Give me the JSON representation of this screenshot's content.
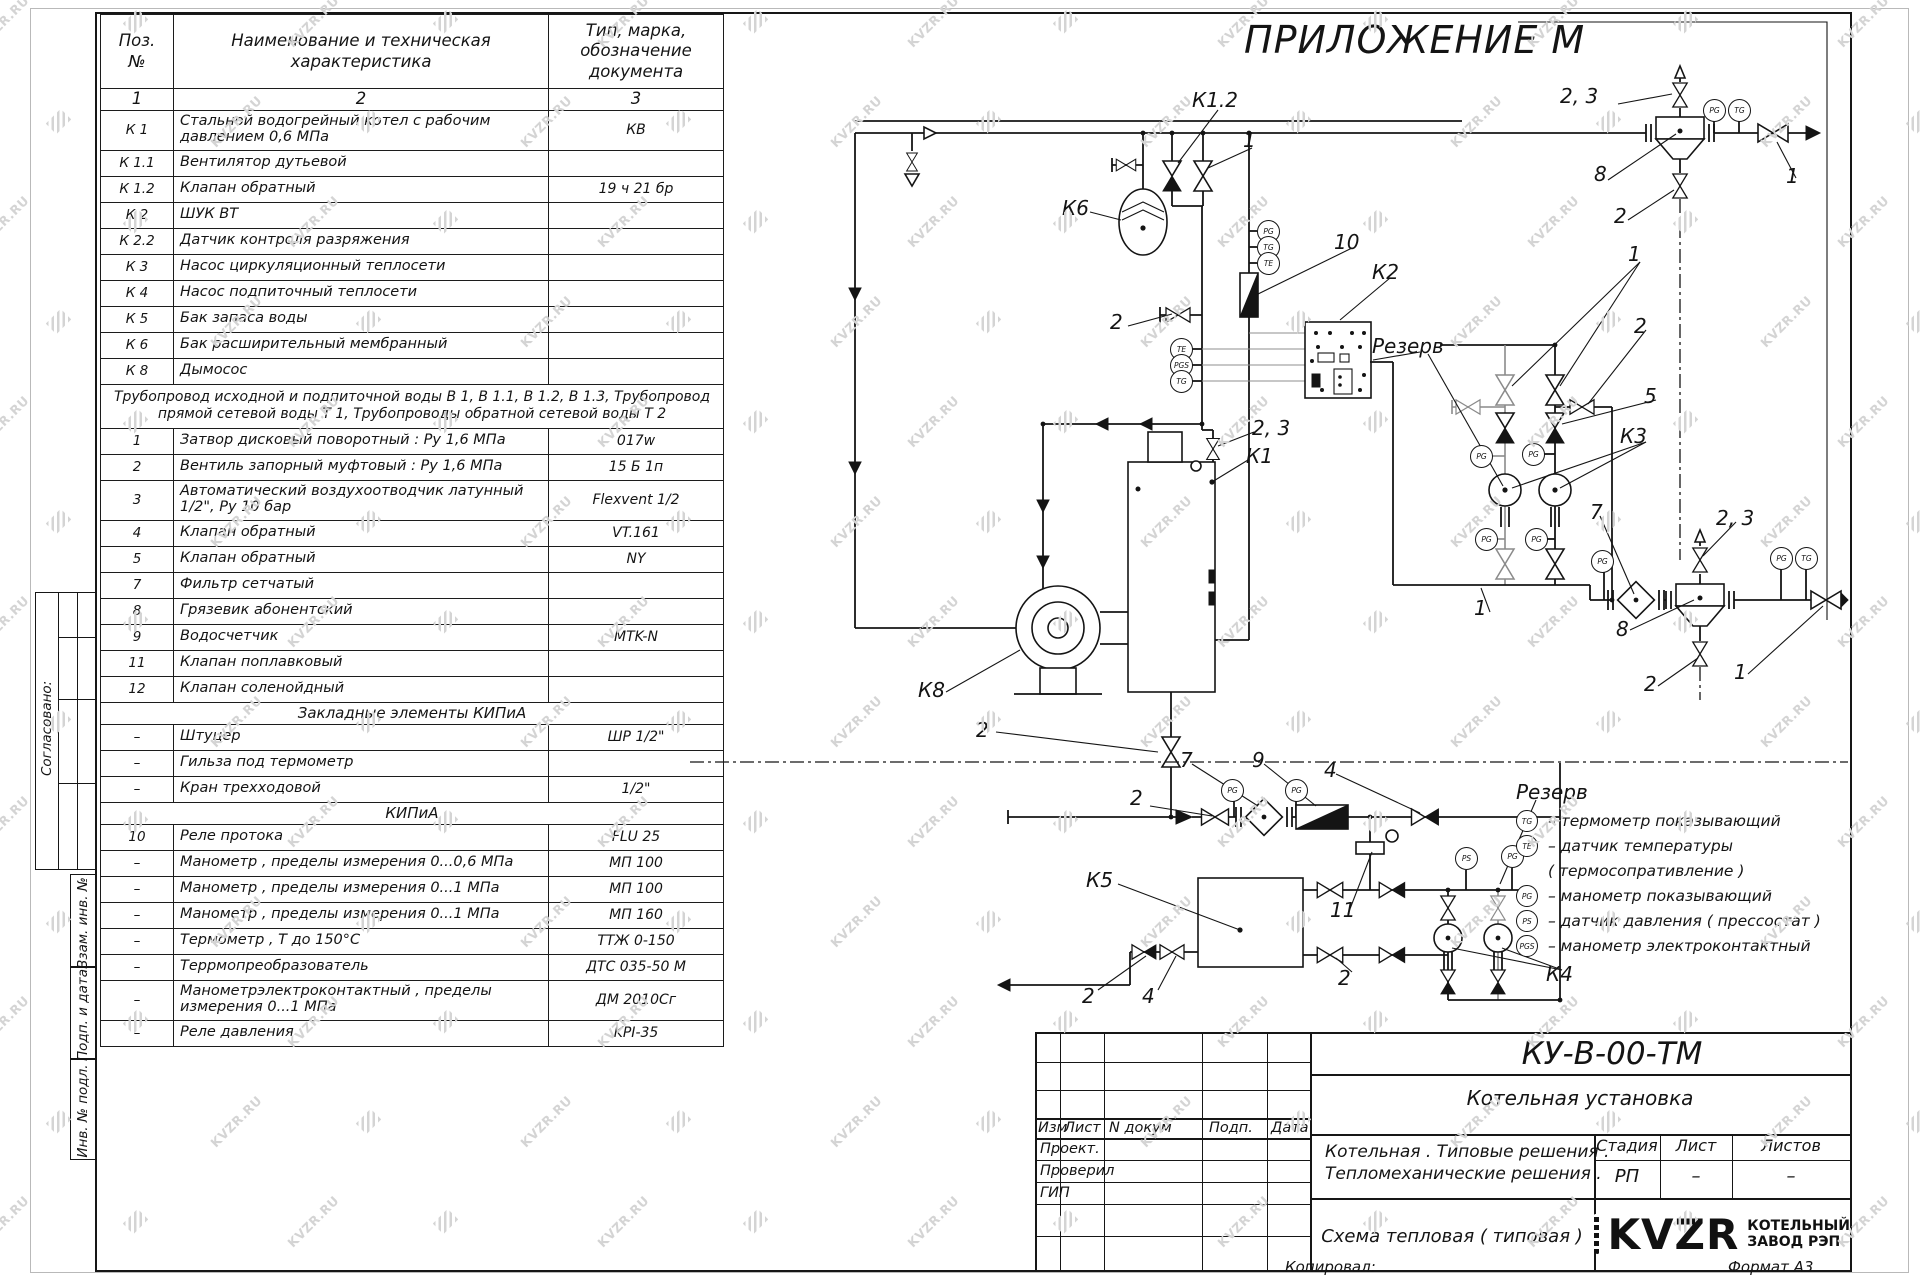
{
  "appendix_title": "ПРИЛОЖЕНИЕ  М",
  "watermark": {
    "text": "KVZR.RU"
  },
  "colors": {
    "ink": "#141414",
    "watermark": "#d4d4d4",
    "paper": "#ffffff"
  },
  "margin": {
    "approved": "Согласовано:",
    "vzam": "Взам. инв. №",
    "podp": "Подп. и дата",
    "inv": "Инв. № подл."
  },
  "spec_table": {
    "col1": "Поз.\n№",
    "col2": "Наименование и техническая\nхарактеристика",
    "col3": "Тип, марка,\nобозначение\nдокумента",
    "index": [
      "1",
      "2",
      "3"
    ],
    "rows": [
      {
        "p": "К 1",
        "n": "Стальной водогрейный котел с рабочим давлением 0,6  МПа",
        "t": "КВ",
        "tall": 1
      },
      {
        "p": "К 1.1",
        "n": "Вентилятор дутьевой",
        "t": ""
      },
      {
        "p": "К 1.2",
        "n": "Клапан обратный",
        "t": "19 ч 21 бр"
      },
      {
        "p": "К 2",
        "n": "ШУК ВТ",
        "t": ""
      },
      {
        "p": "К 2.2",
        "n": "Датчик контроля разряжения",
        "t": ""
      },
      {
        "p": "К 3",
        "n": "Насос циркуляционный теплосети",
        "t": ""
      },
      {
        "p": "К 4",
        "n": "Насос подпиточный теплосети",
        "t": ""
      },
      {
        "p": "К 5",
        "n": "Бак запаса воды",
        "t": ""
      },
      {
        "p": "К 6",
        "n": "Бак расширительный мембранный",
        "t": ""
      },
      {
        "p": "К 8",
        "n": "Дымосос",
        "t": ""
      },
      {
        "note": "Трубопровод исходной и подпиточной воды В 1,   В 1.1,   В 1.2, В 1.3,  Трубопровод прямой сетевой воды Т 1,  Трубопроводы обратной сетевой воды Т 2"
      },
      {
        "p": "1",
        "n": "Затвор дисковый поворотный :  Ру 1,6  МПа",
        "t": "017w"
      },
      {
        "p": "2",
        "n": "Вентиль запорный муфтовый :  Ру 1,6  МПа",
        "t": "15 Б 1п"
      },
      {
        "p": "3",
        "n": "Автоматический воздухоотводчик  латунный 1/2\",  Ру 10 бар",
        "t": "Flexvent 1/2",
        "tall": 1
      },
      {
        "p": "4",
        "n": "Клапан обратный",
        "t": "VT.161"
      },
      {
        "p": "5",
        "n": "Клапан обратный",
        "t": "NY"
      },
      {
        "p": "7",
        "n": "Фильтр сетчатый",
        "t": ""
      },
      {
        "p": "8",
        "n": "Грязевик абонентский",
        "t": ""
      },
      {
        "p": "9",
        "n": "Водосчетчик",
        "t": "MTK-N"
      },
      {
        "p": "11",
        "n": "Клапан поплавковый",
        "t": ""
      },
      {
        "p": "12",
        "n": "Клапан соленойдный",
        "t": ""
      },
      {
        "sec": "Закладные элементы КИПиА"
      },
      {
        "p": "–",
        "n": "Штуцер",
        "t": "ШР  1/2\""
      },
      {
        "p": "–",
        "n": "Гильза под термометр",
        "t": ""
      },
      {
        "p": "–",
        "n": "Кран трехходовой",
        "t": "1/2\""
      },
      {
        "sec": "КИПиА"
      },
      {
        "p": "10",
        "n": "Реле протока",
        "t": "FLU 25"
      },
      {
        "p": "–",
        "n": "Манометр ,  пределы измерения  0...0,6 МПа",
        "t": "МП 100"
      },
      {
        "p": "–",
        "n": "Манометр ,  пределы измерения  0...1 МПа",
        "t": "МП 100"
      },
      {
        "p": "–",
        "n": "Манометр ,  пределы измерения  0...1 МПа",
        "t": "МП 160"
      },
      {
        "p": "–",
        "n": "Термометр ,  Т  до  150°С",
        "t": "ТТЖ  0-150"
      },
      {
        "p": "–",
        "n": "Террмопреобразователь",
        "t": "ДТС 035-50 М"
      },
      {
        "p": "–",
        "n": "Манометрэлектроконтактный ,  пределы измерения 0...1 МПа",
        "t": "ДМ 2010Сг",
        "tall": 1
      },
      {
        "p": "–",
        "n": "Реле давления",
        "t": "KPI-35"
      }
    ]
  },
  "diagram": {
    "labels": [
      {
        "t": "К1.2",
        "x": 1192,
        "y": 88
      },
      {
        "t": "1",
        "x": 1243,
        "y": 128
      },
      {
        "t": "2, 3",
        "x": 1560,
        "y": 84
      },
      {
        "t": "8",
        "x": 1594,
        "y": 162
      },
      {
        "t": "2",
        "x": 1614,
        "y": 204
      },
      {
        "t": "1",
        "x": 1786,
        "y": 164
      },
      {
        "t": "К6",
        "x": 1062,
        "y": 196
      },
      {
        "t": "10",
        "x": 1334,
        "y": 230
      },
      {
        "t": "К2",
        "x": 1372,
        "y": 260
      },
      {
        "t": "2",
        "x": 1110,
        "y": 310
      },
      {
        "t": "Резерв",
        "x": 1372,
        "y": 334
      },
      {
        "t": "1",
        "x": 1628,
        "y": 242
      },
      {
        "t": "2",
        "x": 1634,
        "y": 314
      },
      {
        "t": "5",
        "x": 1644,
        "y": 384
      },
      {
        "t": "К3",
        "x": 1620,
        "y": 424
      },
      {
        "t": "2, 3",
        "x": 1252,
        "y": 416
      },
      {
        "t": "К1",
        "x": 1246,
        "y": 444
      },
      {
        "t": "7",
        "x": 1590,
        "y": 500
      },
      {
        "t": "2, 3",
        "x": 1716,
        "y": 506
      },
      {
        "t": "1",
        "x": 1474,
        "y": 596
      },
      {
        "t": "8",
        "x": 1616,
        "y": 617
      },
      {
        "t": "2",
        "x": 1644,
        "y": 672
      },
      {
        "t": "1",
        "x": 1734,
        "y": 660
      },
      {
        "t": "К8",
        "x": 918,
        "y": 678
      },
      {
        "t": "2",
        "x": 976,
        "y": 718
      },
      {
        "t": "2",
        "x": 1130,
        "y": 786
      },
      {
        "t": "7",
        "x": 1180,
        "y": 748
      },
      {
        "t": "9",
        "x": 1252,
        "y": 748
      },
      {
        "t": "4",
        "x": 1324,
        "y": 758
      },
      {
        "t": "К5",
        "x": 1086,
        "y": 868
      },
      {
        "t": "11",
        "x": 1330,
        "y": 898
      },
      {
        "t": "Резерв",
        "x": 1516,
        "y": 780
      },
      {
        "t": "2",
        "x": 1338,
        "y": 966
      },
      {
        "t": "К4",
        "x": 1546,
        "y": 962
      },
      {
        "t": "2",
        "x": 1082,
        "y": 984
      },
      {
        "t": "4",
        "x": 1142,
        "y": 984
      }
    ],
    "instruments": [
      {
        "l": "PG",
        "x": 1714,
        "y": 110
      },
      {
        "l": "TG",
        "x": 1739,
        "y": 110
      },
      {
        "l": "PG",
        "x": 1268,
        "y": 231
      },
      {
        "l": "TG",
        "x": 1268,
        "y": 247
      },
      {
        "l": "TE",
        "x": 1268,
        "y": 263
      },
      {
        "l": "TE",
        "x": 1181,
        "y": 349
      },
      {
        "l": "PGS",
        "x": 1181,
        "y": 365
      },
      {
        "l": "TG",
        "x": 1181,
        "y": 381
      },
      {
        "l": "PG",
        "x": 1481,
        "y": 456
      },
      {
        "l": "PG",
        "x": 1533,
        "y": 454
      },
      {
        "l": "PG",
        "x": 1486,
        "y": 539
      },
      {
        "l": "PG",
        "x": 1536,
        "y": 539
      },
      {
        "l": "PG",
        "x": 1602,
        "y": 561
      },
      {
        "l": "PG",
        "x": 1781,
        "y": 558
      },
      {
        "l": "TG",
        "x": 1806,
        "y": 558
      },
      {
        "l": "PG",
        "x": 1232,
        "y": 790
      },
      {
        "l": "PG",
        "x": 1296,
        "y": 790
      },
      {
        "l": "PS",
        "x": 1466,
        "y": 858
      },
      {
        "l": "PG",
        "x": 1512,
        "y": 856
      }
    ]
  },
  "legend": {
    "items": [
      {
        "sym": "TG",
        "text": "–  термометр показывающий"
      },
      {
        "sym": "TE",
        "text": "–  датчик температуры"
      },
      {
        "sym": "",
        "text": "( термосопративление )"
      },
      {
        "sym": "PG",
        "text": "–  манометр показывающий"
      },
      {
        "sym": "PS",
        "text": "–  датчик давления  ( прессостат )"
      },
      {
        "sym": "PGS",
        "text": "–  манометр электроконтактный"
      }
    ]
  },
  "title_block": {
    "doc_number": "КУ-В-00-ТМ",
    "object_name": "Котельная установка",
    "cols": {
      "izm": "Изм",
      "list": "Лист",
      "ndoc": "N докум",
      "podp": "Подп.",
      "data": "Дата"
    },
    "roles": [
      "Проект.",
      "Проверил",
      "ГИП"
    ],
    "project_line1": "Котельная . Типовые решения .",
    "project_line2": "Тепломеханические решения .",
    "stage_label": "Стадия",
    "sheet_label": "Лист",
    "sheets_label": "Листов",
    "stage": "РП",
    "sheet": "–",
    "sheets": "–",
    "drawing_name": "Схема тепловая ( типовая )",
    "company_logo": "KVZR",
    "company_line1": "КОТЕЛЬНЫЙ",
    "company_line2": "ЗАВОД РЭП",
    "copied_label": "Копировал:",
    "format_label": "Формат А3"
  }
}
